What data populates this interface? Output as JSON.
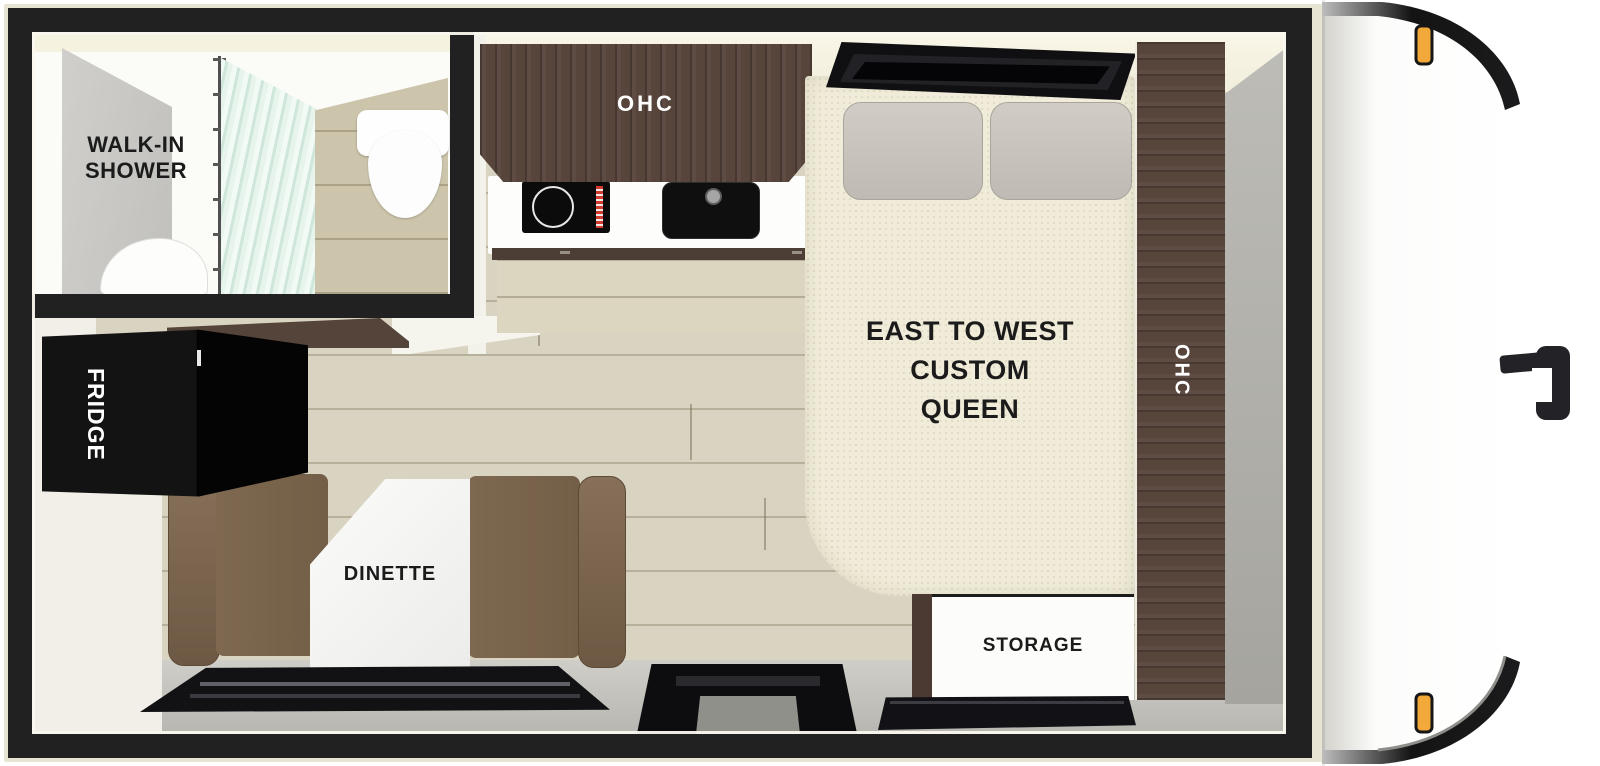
{
  "labels": {
    "bathroom_line1": "WALK-IN",
    "bathroom_line2": "SHOWER",
    "kitchen_ohc": "OHC",
    "bed_line1": "EAST TO WEST",
    "bed_line2": "CUSTOM",
    "bed_line3": "QUEEN",
    "right_cabinet_ohc": "OHC",
    "fridge": "FRIDGE",
    "dinette": "DINETTE",
    "storage": "STORAGE"
  },
  "colors": {
    "wall": "#212121",
    "body_outline": "#e8e4d4",
    "dark_wood": "#57453c",
    "floor_plank": "#d9d4c1",
    "bed_mattress": "#f0ecd9",
    "bench_brown": "#7b654e",
    "marble_table": "#f8f8f6",
    "gray_wall": "#b3b2ac",
    "marker_light_amber": "#f3a83a"
  }
}
